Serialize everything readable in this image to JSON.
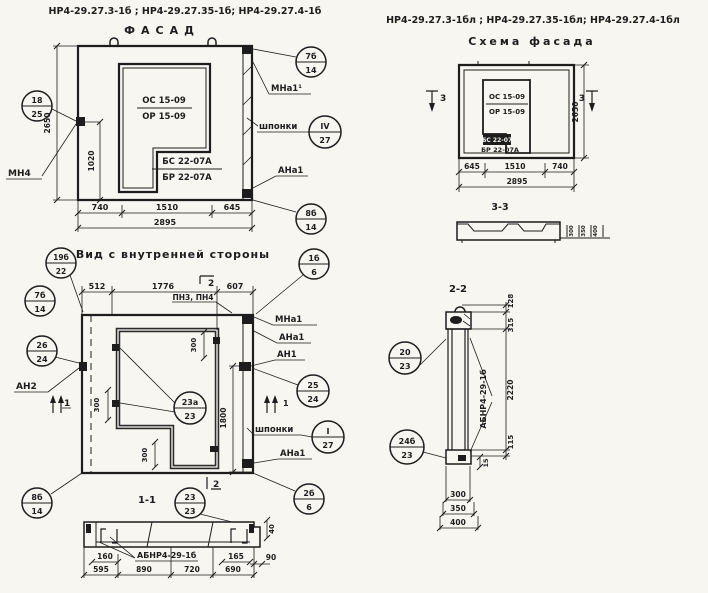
{
  "sheet": {
    "paper": "#f8f6f1",
    "ink": "#1d1d1d"
  },
  "titles": {
    "left_marks": "НР4-29.27.3-1б ;  НР4-29.27.35-1б;  НР4-29.27.4-1б",
    "left_view": "ФАСАД",
    "right_marks": "НР4-29.27.3-1бл ;  НР4-29.27.35-1бл;  НР4-29.27.4-1бл",
    "right_view": "Схема фасада"
  },
  "facade": {
    "window_mark_top": "ОС 15-09",
    "window_mark_bot": "ОР 15-09",
    "block_mark_top": "БС 22-07А",
    "block_mark_bot": "БР 22-07А",
    "dim_height": "2650",
    "dim_sill": "1020",
    "dims_bottom": [
      "740",
      "1510",
      "645"
    ],
    "dim_total": "2895",
    "label_mn4": "МН4",
    "label_mna1": "МНа1¹",
    "label_shponki": "шпонки",
    "label_ana1": "АНа1",
    "callouts": {
      "c18": {
        "top": "18",
        "bot": "25"
      },
      "c7b": {
        "top": "7б",
        "bot": "14"
      },
      "csh": {
        "top": "IV",
        "bot": "27"
      },
      "c8b": {
        "top": "8б",
        "bot": "14"
      }
    }
  },
  "scheme": {
    "window_mark_top": "ОС 15-09",
    "window_mark_bot": "ОР 15-09",
    "block_mark_top": "БС 22-07",
    "block_mark_bot": "БР 22-07А",
    "mark3": "3",
    "dim_height": "2650",
    "dims_bottom": [
      "645",
      "1510",
      "740"
    ],
    "dim_total": "2895",
    "section_title": "3-3",
    "section_dims": [
      "300",
      "350",
      "400"
    ]
  },
  "inner": {
    "title": "Вид с внутренней стороны",
    "dims_top": [
      "512",
      "1776",
      "607"
    ],
    "label_pn": "ПН3, ПН4",
    "label_an2": "АН2",
    "label_mna1": "МНа1",
    "label_ana1_top": "АНа1",
    "label_an1": "АН1",
    "label_shponki": "шпонки",
    "label_ana1_bot": "АНа1",
    "dim_1800": "1800",
    "dim_300": "300",
    "mark1": "1",
    "mark2": "2",
    "callouts": {
      "c19b": {
        "top": "19б",
        "bot": "22"
      },
      "c1b": {
        "top": "1б",
        "bot": "6"
      },
      "c7b": {
        "top": "7б",
        "bot": "14"
      },
      "c26": {
        "top": "26",
        "bot": "24"
      },
      "c25": {
        "top": "25",
        "bot": "24"
      },
      "c23a": {
        "top": "23а",
        "bot": "23"
      },
      "csh": {
        "top": "I",
        "bot": "27"
      },
      "c8b": {
        "top": "8б",
        "bot": "14"
      },
      "c2b": {
        "top": "2б",
        "bot": "6"
      }
    }
  },
  "section11": {
    "title": "1-1",
    "label": "АБНР4-29-1б",
    "dim_160": "160",
    "dim_165": "165",
    "dim_90": "90",
    "dim_40": "40",
    "dims_bottom": [
      "595",
      "890",
      "720",
      "690"
    ],
    "callouts": {
      "c23": {
        "top": "23",
        "bot": "23"
      }
    }
  },
  "section22": {
    "title": "2-2",
    "label": "АБНР4-29-1б",
    "dims_right": [
      "128",
      "315",
      "2220",
      "115"
    ],
    "dim_15": "15",
    "dims_bottom": [
      "300",
      "350",
      "400"
    ],
    "callouts": {
      "c20": {
        "top": "20",
        "bot": "23"
      },
      "c24b": {
        "top": "24б",
        "bot": "23"
      }
    }
  }
}
